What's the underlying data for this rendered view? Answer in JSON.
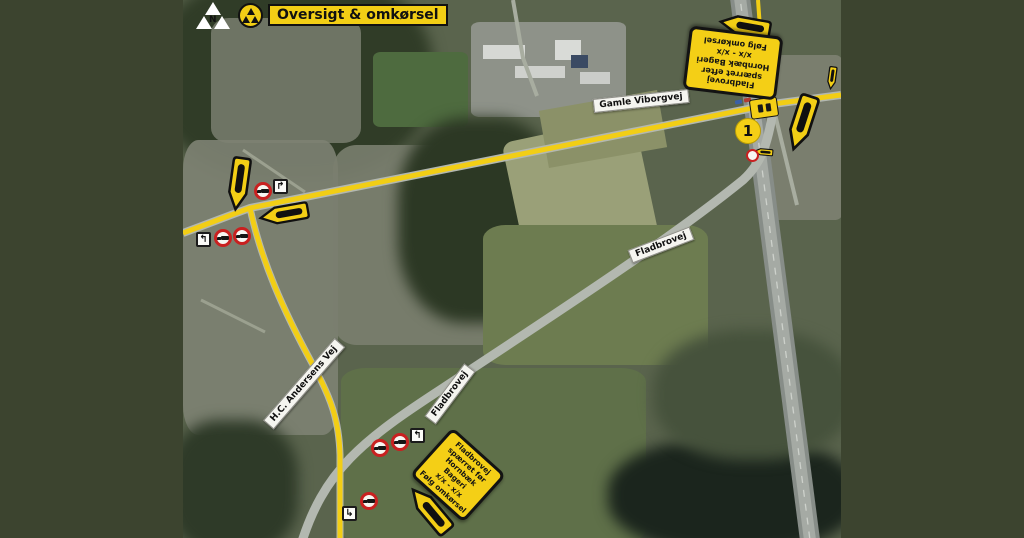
{
  "header": {
    "title": "Oversigt & omkørsel",
    "north_label": "N"
  },
  "markers": {
    "point1": "1"
  },
  "road_labels": {
    "gamle_viborgvej": "Gamle Viborgvej",
    "fladbrovej_upper": "Fladbrovej",
    "fladbrovej_lower": "Fladbrovej",
    "hc_andersens_vej": "H.C. Andersens Vej"
  },
  "signs": {
    "north_sign": {
      "lines": [
        "Fladbrovej",
        "spærret efter",
        "Hornbæk Bageri",
        "x/x - x/x",
        "Følg omkørsel"
      ]
    },
    "south_sign": {
      "lines": [
        "Fladbrovej",
        "spærret før",
        "Hornbæk Bageri",
        "x/x - x/x",
        "Følg omkørsel"
      ]
    }
  },
  "icons": {
    "turn_right": "↱",
    "turn_left": "↰",
    "turn_hook": "↳"
  },
  "colors": {
    "route_yellow": "#f2ce15",
    "frame_green": "#3c442f",
    "prohibition_red": "#c92020"
  }
}
